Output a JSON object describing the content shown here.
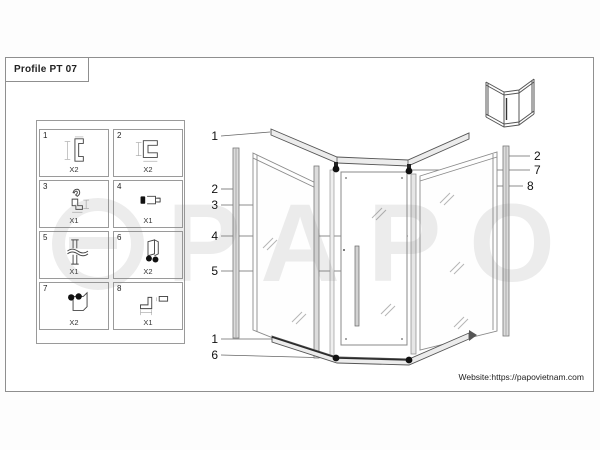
{
  "sheet": {
    "title": "Profile PT 07",
    "website": "Website:https://papovietnam.com"
  },
  "watermark": {
    "text": "PAPO"
  },
  "parts_legend": {
    "items": [
      {
        "num": "1",
        "qty": "X2",
        "icon": "wall-channel-profile"
      },
      {
        "num": "2",
        "qty": "X2",
        "icon": "c-profile"
      },
      {
        "num": "3",
        "qty": "X1",
        "icon": "hook-bracket"
      },
      {
        "num": "4",
        "qty": "X1",
        "icon": "clamp-fitting"
      },
      {
        "num": "5",
        "qty": "X1",
        "icon": "support-bar"
      },
      {
        "num": "6",
        "qty": "X2",
        "icon": "bottom-roller"
      },
      {
        "num": "7",
        "qty": "X2",
        "icon": "top-roller"
      },
      {
        "num": "8",
        "qty": "X1",
        "icon": "l-angle-profile"
      }
    ]
  },
  "callouts": {
    "left": [
      {
        "label": "1"
      },
      {
        "label": "2"
      },
      {
        "label": "3"
      },
      {
        "label": "4"
      },
      {
        "label": "5"
      },
      {
        "label": "1"
      },
      {
        "label": "6"
      }
    ],
    "right": [
      {
        "label": "2"
      },
      {
        "label": "7"
      },
      {
        "label": "8"
      }
    ]
  },
  "colors": {
    "frame_border": "#8f8f8f",
    "drawing_line": "#555555",
    "roller": "#111111",
    "watermark": "rgba(130,130,130,0.15)"
  }
}
